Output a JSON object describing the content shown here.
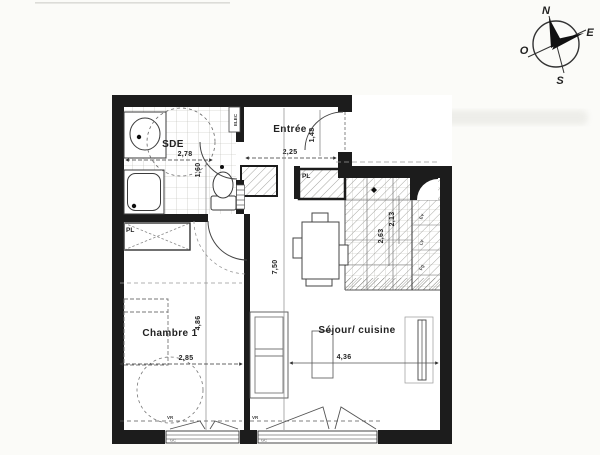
{
  "title": "Plan d'appartement",
  "compass": {
    "north": "N",
    "east": "E",
    "south": "S",
    "west": "O"
  },
  "rooms": {
    "sde": {
      "name": "SDE",
      "width": "2,78",
      "depth": "1,60"
    },
    "entree": {
      "name": "Entrée",
      "width": "2,25",
      "depth": "1,48"
    },
    "chambre": {
      "name": "Chambre 1",
      "width": "2,85",
      "depth": "4,86"
    },
    "sejour": {
      "name": "Séjour/ cuisine",
      "width": "4,36",
      "depth": "7,50"
    },
    "cuisine": {
      "dim_a": "2,13",
      "dim_b": "2,63"
    }
  },
  "labels": {
    "closet": "PL",
    "elec": "ELEC",
    "shutter": "VR",
    "guardrail": "GC",
    "appliance_1": "Ev",
    "appliance_2": "LV",
    "appliance_3": "Fg"
  },
  "colors": {
    "wall": "#1c1c1c",
    "line": "#444444",
    "thin": "#777777",
    "hatch": "#8a8a8a",
    "paper": "#fbfbf8"
  }
}
